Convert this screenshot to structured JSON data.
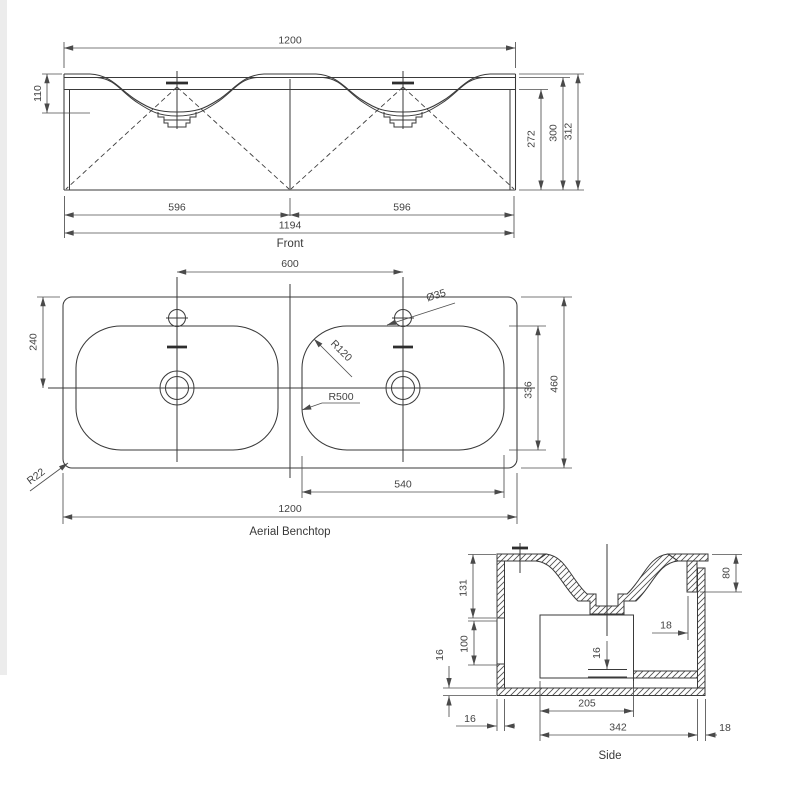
{
  "page": {
    "background": "#ffffff",
    "line_color": "#3a3a3a",
    "dim_color": "#4f4f4f"
  },
  "views": {
    "front": {
      "label": "Front",
      "dims": {
        "bench_width": "1200",
        "basin_depth": "110",
        "height_under_top": "272",
        "height_mid": "300",
        "height_total": "312",
        "half_left": "596",
        "half_right": "596",
        "cabinet_width": "1194"
      }
    },
    "aerial": {
      "label": "Aerial Benchtop",
      "dims": {
        "tap_centres": "600",
        "tap_hole_diameter": "Ø35",
        "centre_from_back": "240",
        "basin_corner_radius": "R120",
        "basin_side_radius": "R500",
        "basin_length": "336",
        "bench_depth": "460",
        "basin_width": "540",
        "bench_width": "1200",
        "bench_corner_radius": "R22"
      }
    },
    "side": {
      "label": "Side",
      "dims": {
        "upper_height": "131",
        "opening_height": "100",
        "bottom_thickness": "16",
        "skirt_drop": "80",
        "skirt_offset": "18",
        "shelf_gap": "16",
        "side_thickness": "16",
        "drawer_depth": "205",
        "cabinet_depth": "342",
        "back_thickness": "18"
      }
    }
  }
}
